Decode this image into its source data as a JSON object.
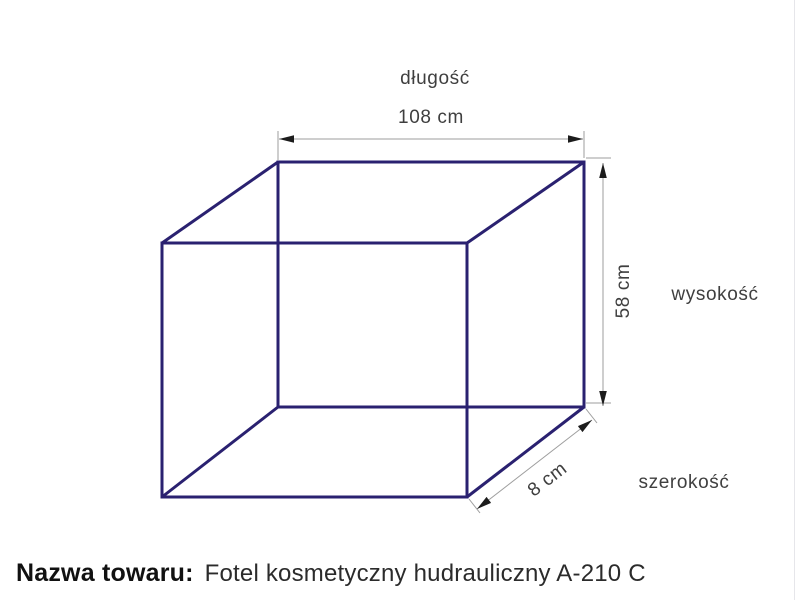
{
  "diagram": {
    "title_context": "product-dimensions-box",
    "colors": {
      "box_line": "#2a2170",
      "dimension_line": "#9e9e9e",
      "arrowhead": "#1c1c1c",
      "label_text": "#3f3f3f"
    },
    "dimensions": {
      "length": {
        "label": "długość",
        "value": "108 cm"
      },
      "height": {
        "label": "wysokość",
        "value": "58 cm"
      },
      "width": {
        "label": "szerokość",
        "value": "8 cm"
      }
    }
  },
  "footer": {
    "label": "Nazwa towaru:",
    "product_name": "Fotel kosmetyczny hudrauliczny A-210 C"
  }
}
